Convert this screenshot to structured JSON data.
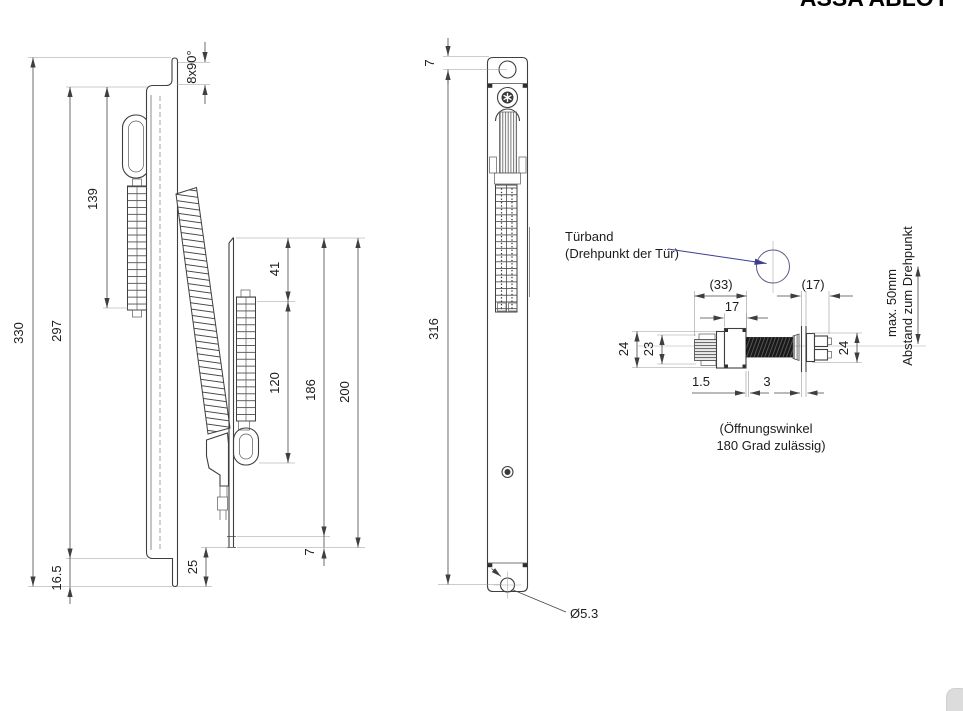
{
  "logo": {
    "text": "ASSA ABLOY"
  },
  "side_view": {
    "dim_overall": "330",
    "dim_plate": "297",
    "dim_terminal": "139",
    "dim_foot": "16.5",
    "dim_bend": "8x90°",
    "door": {
      "dim_top_gap": "41",
      "dim_terminal": "120",
      "dim_inner": "186",
      "dim_total": "200",
      "dim_foot": "7",
      "dim_offset": "25"
    }
  },
  "front_view": {
    "dim_hole_top": "7",
    "dim_hole_span": "316",
    "dim_hole_dia": "Ø5.3"
  },
  "detail_view": {
    "label_hinge_1": "Türband",
    "label_hinge_2": "(Drehpunkt der Tür)",
    "dim_plug_total": "(33)",
    "dim_socket_total": "(17)",
    "dim_body": "17",
    "dim_height_outer": "24",
    "dim_height_inner": "23",
    "dim_socket_height": "24",
    "dim_step": "1.5",
    "dim_gap": "3",
    "note_max_1": "max. 50mm",
    "note_max_2": "Abstand zum Drehpunkt",
    "note_opening_1": "(Öffnungswinkel",
    "note_opening_2": "180 Grad zulässig)"
  },
  "colors": {
    "line": "#3f3f3f",
    "dimension": "#474747",
    "extension": "#9a9a9a",
    "leader_blue": "#3d3d94",
    "tube_fill": "#191919"
  }
}
